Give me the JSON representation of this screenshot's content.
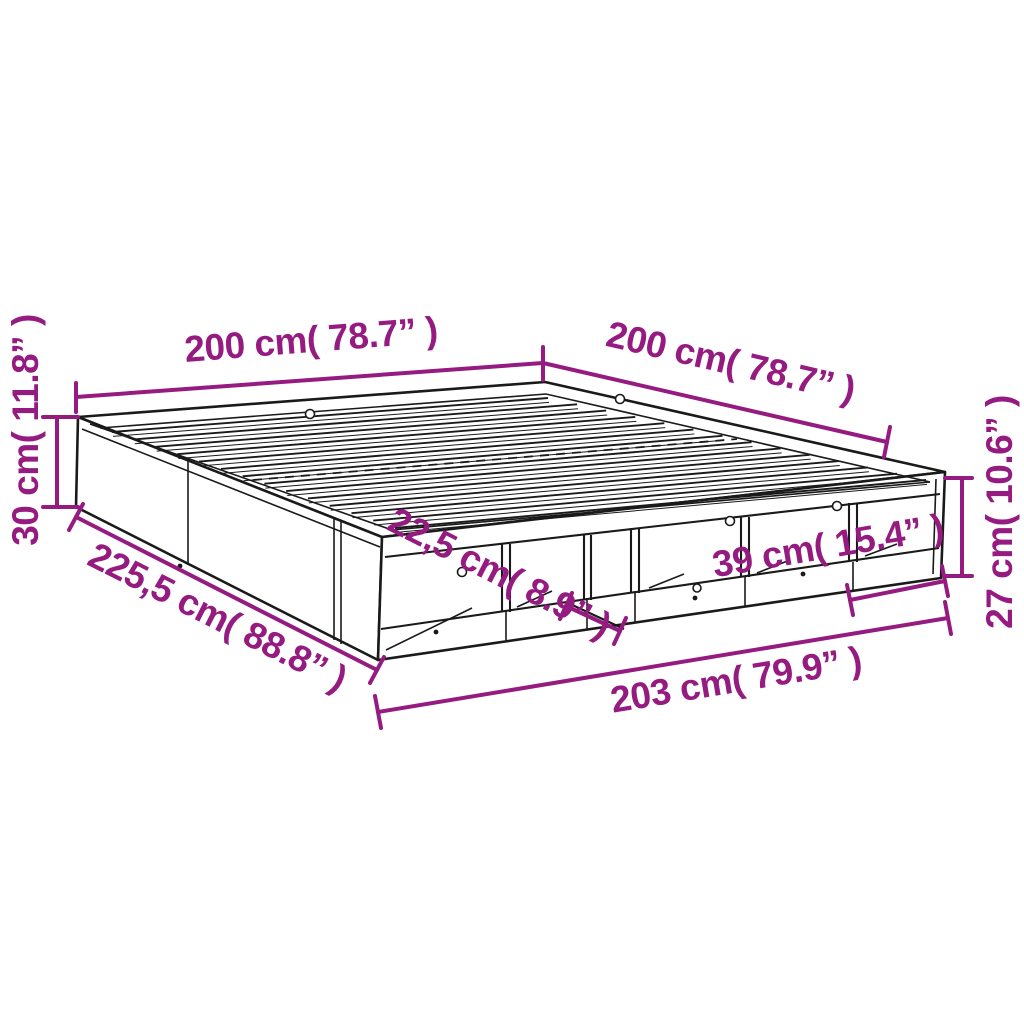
{
  "figure": {
    "kind": "product-dimension-diagram",
    "subject": "bed-frame-with-storage-compartments",
    "accent_color": "#951B81",
    "line_color": "#1a1a1a",
    "background_color": "#ffffff"
  },
  "dimensions": {
    "top_left_length": "200 cm( 78.7” )",
    "top_right_width": "200 cm( 78.7” )",
    "frame_height": "30 cm( 11.8” )",
    "side_total_length": "225,5 cm( 88.8” )",
    "compartment_depth": "22,5 cm( 8.9” )",
    "compartment_width": "39 cm( 15.4” )",
    "compartment_height": "27 cm( 10.6” )",
    "front_total_length": "203 cm( 79.9” )"
  }
}
